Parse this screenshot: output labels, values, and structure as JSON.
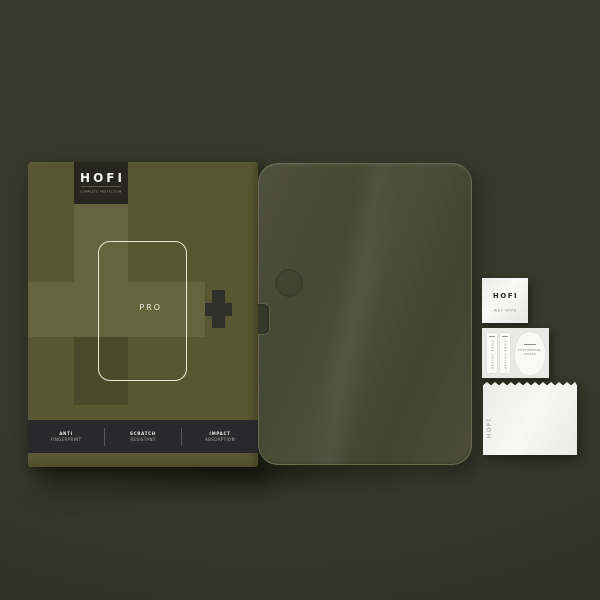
{
  "box": {
    "brand": "HOFI",
    "tagline": "COMPLETE PROTECTION",
    "model_label": "PRO",
    "plus_glyph": "+",
    "features": [
      {
        "line1": "ANTI",
        "line2": "FINGERPRINT"
      },
      {
        "line1": "SCRATCH",
        "line2": "RESISTANT"
      },
      {
        "line1": "IMPACT",
        "line2": "ABSORPTION"
      }
    ]
  },
  "accessories": {
    "wet_wipe": {
      "brand": "HOFI",
      "label": "WET WIPE"
    },
    "sticker_sheet": {
      "guide_sticker_label": "GUIDE STICKER",
      "dust_removal_line1": "DUST REMOVAL",
      "dust_removal_line2": "STICKER"
    },
    "cloth": {
      "brand": "HOFI"
    }
  },
  "icons": {
    "pro_plus": "plus-cross",
    "tablet_outline": "tablet-silhouette",
    "camera_mark": "camera-circle"
  },
  "colors": {
    "background": "#36382a",
    "background_deep": "#2c2f23",
    "box_base": "#575732",
    "box_light": "#65653d",
    "box_dark": "#4a4a2b",
    "panel_dark": "#26261f",
    "bar_dark": "#29292b",
    "outline_cream": "#eae7d6",
    "plus_dark": "#30302b",
    "glass_fill": "#454833",
    "paper": "#f3f3f0",
    "paper_dim": "#e9e9e6",
    "ink_dark": "#2b2a24",
    "text_light": "#f2f2ee"
  }
}
